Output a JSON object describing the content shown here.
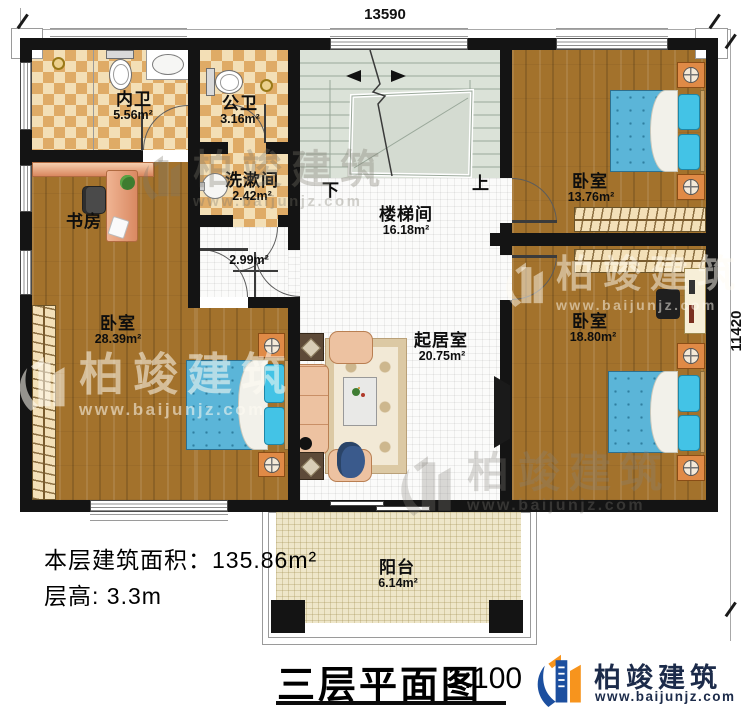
{
  "dimensions": {
    "top": "13590",
    "right": "11420"
  },
  "rooms": {
    "neiwei": {
      "name": "内卫",
      "area": "5.56m²"
    },
    "gongwei": {
      "name": "公卫",
      "area": "3.16m²"
    },
    "xishujian": {
      "name": "洗漱间",
      "area": "2.42m²"
    },
    "shufang": {
      "name": "书房"
    },
    "hall": {
      "area": "2.99m²"
    },
    "loutijian": {
      "name": "楼梯间",
      "area": "16.18m²"
    },
    "bedroom_tr": {
      "name": "卧室",
      "area": "13.76m²"
    },
    "bedroom_left": {
      "name": "卧室",
      "area": "28.39m²"
    },
    "bedroom_br": {
      "name": "卧室",
      "area": "18.80m²"
    },
    "qijushi": {
      "name": "起居室",
      "area": "20.75m²"
    },
    "yangtai": {
      "name": "阳台",
      "area": "6.14m²"
    }
  },
  "stairs": {
    "down": "下",
    "up": "上"
  },
  "info": {
    "line1": "本层建筑面积：135.86m²",
    "line2": "层高: 3.3m"
  },
  "titleblock": {
    "title": "三层平面图",
    "scale": "1:100"
  },
  "brand": {
    "name": "柏竣建筑",
    "url": "www.baijunjz.com"
  },
  "watermark": {
    "name": "柏竣建筑",
    "url": "www.baijunjz.com"
  },
  "colors": {
    "wall": "#141414",
    "wood_floor": "#a3722c",
    "tile_dark": "#dfab66",
    "tile_light": "#f3dfb6",
    "stair_floor": "#dbe2d8",
    "bed_blue": "#5bb5d8",
    "balcony_floor": "#eee6c9",
    "logo_blue": "#1c4f9f",
    "logo_orange": "#f7941d"
  }
}
